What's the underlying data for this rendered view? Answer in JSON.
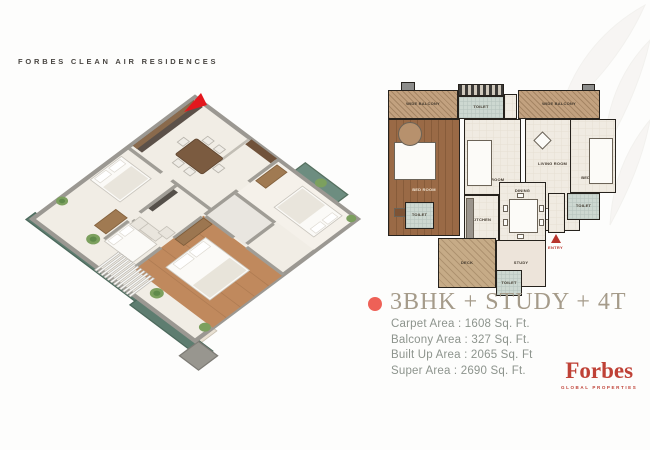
{
  "header": {
    "brand": "FORBES CLEAN AIR RESIDENCES"
  },
  "unit": {
    "title": "3BHK + STUDY + 4T",
    "areas": [
      "Carpet Area : 1608 Sq. Ft.",
      "Balcony Area : 327 Sq. Ft.",
      "Built Up Area : 2065 Sq. Ft",
      "Super Area : 2690 Sq. Ft."
    ]
  },
  "logo": {
    "wordmark": "Forbes",
    "tagline": "GLOBAL PROPERTIES"
  },
  "plan2d": {
    "labels": {
      "balcony": "WIDE BALCONY",
      "bedroom": "BED ROOM",
      "living": "LIVING ROOM",
      "dining": "DINING",
      "kitchen": "KITCHEN",
      "study": "STUDY",
      "toilet": "TOILET",
      "deck": "DECK",
      "entry": "ENTRY"
    }
  },
  "colors": {
    "accent_bullet": "#ee6157",
    "forbes_red": "#bf4136",
    "entry_red": "#b8342c",
    "arrow_red": "#e3171d",
    "title_taupe": "#a59b8a",
    "body_gray_green": "#8d948d",
    "balcony_tan": "#c2a17f",
    "master_wood": "#9a6a46",
    "balcony_teal": "#5e7d70",
    "iso_wood_floor": "#c0895d",
    "iso_floor_cream": "#f1ede5"
  }
}
